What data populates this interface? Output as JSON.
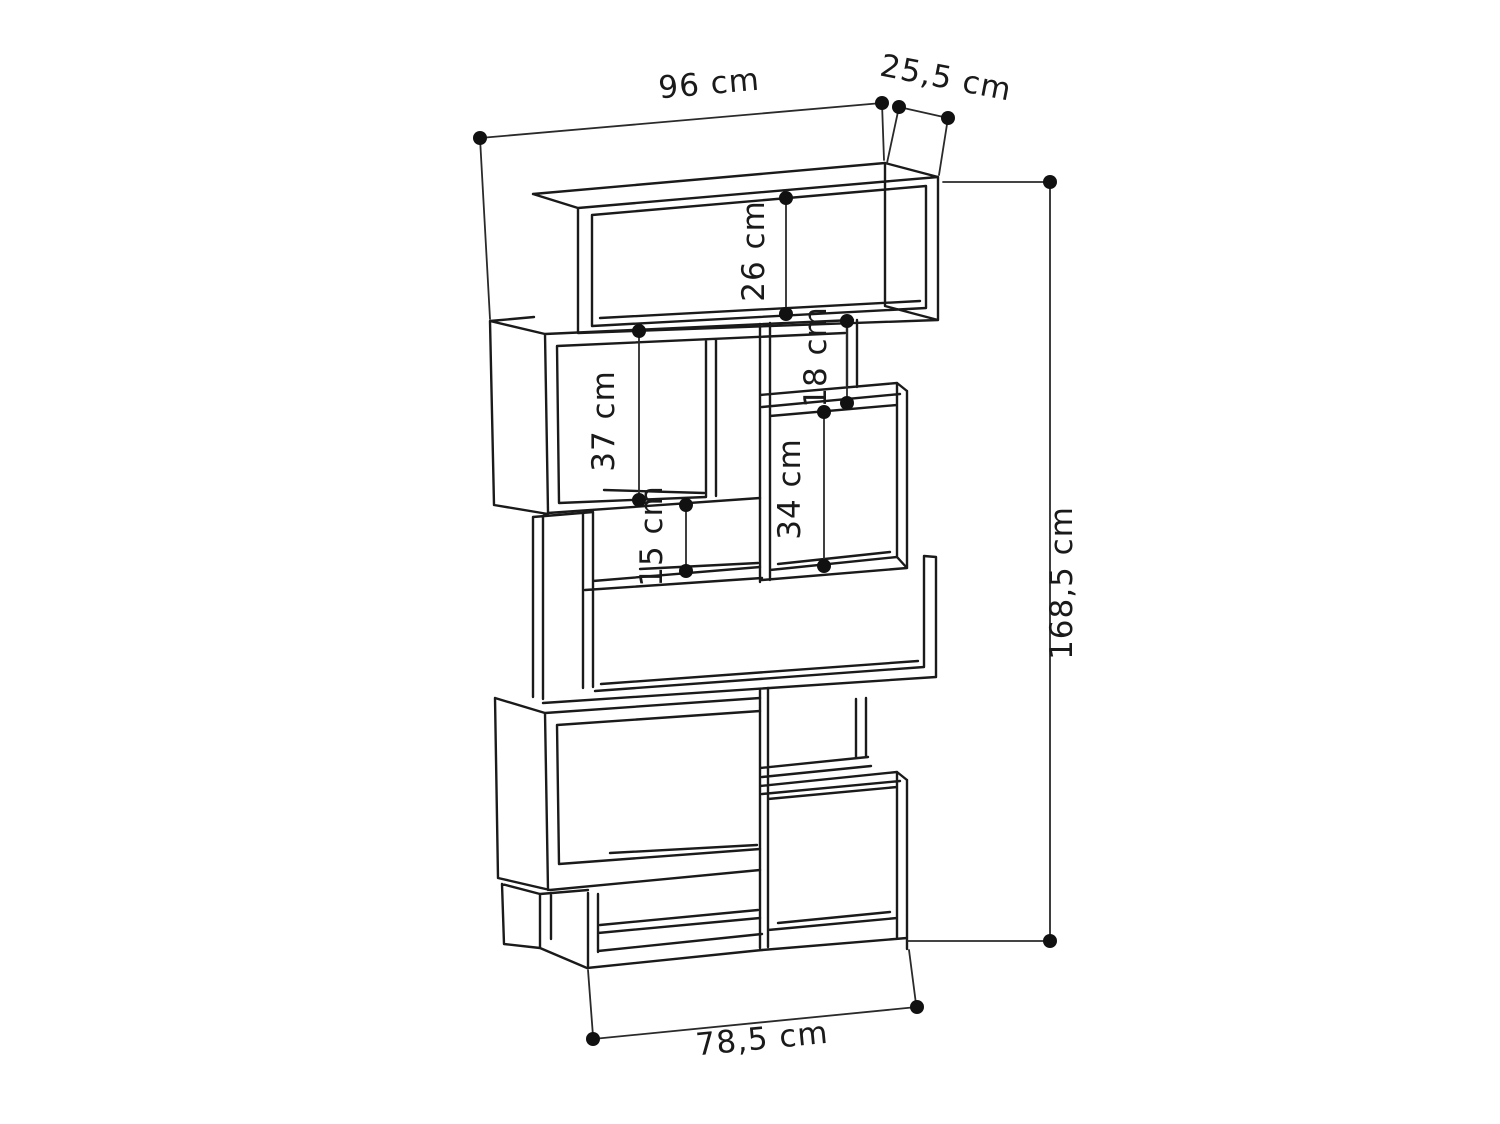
{
  "diagram": {
    "type": "furniture-dimension-drawing",
    "subject": "zigzag open bookcase",
    "background_color": "#ffffff",
    "line_color": "#1a1a1a",
    "dims": {
      "overall_width": "96 cm",
      "depth": "25,5 cm",
      "overall_height": "168,5 cm",
      "base_width": "78,5 cm",
      "top_shelf_height": "26 cm",
      "upper_left_shelf_height": "37 cm",
      "upper_right_small_shelf_height": "18 cm",
      "right_shelf_height": "34 cm",
      "middle_slot_height": "15 cm"
    }
  }
}
